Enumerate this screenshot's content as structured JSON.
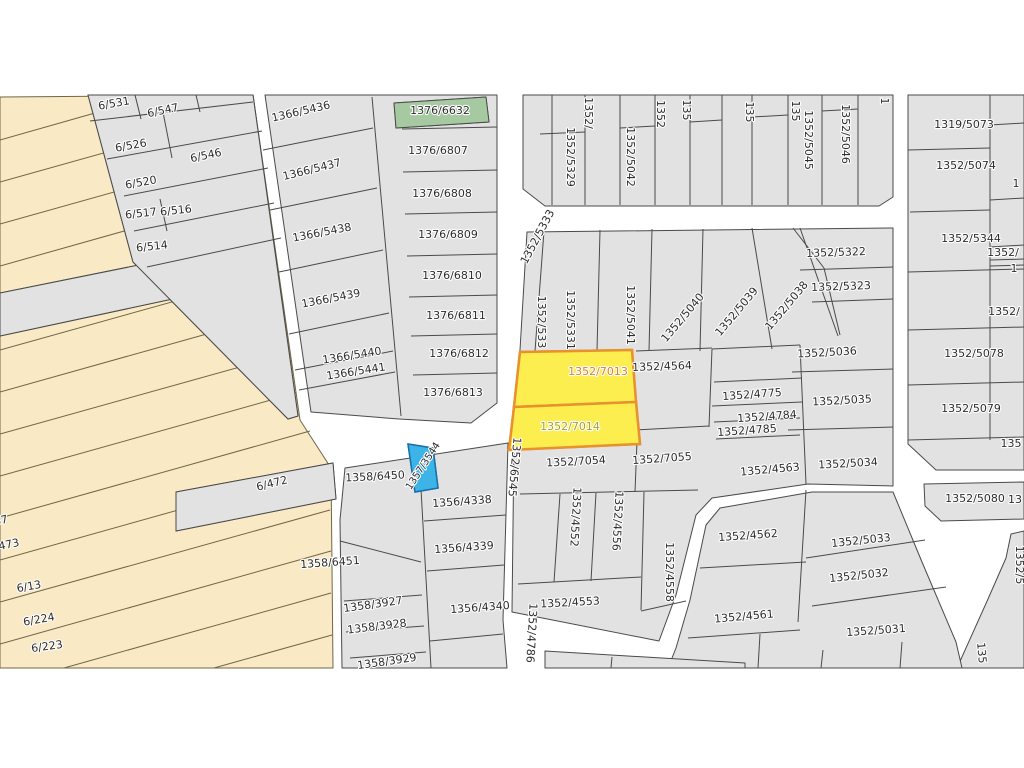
{
  "canvas": {
    "w": 1024,
    "h": 768,
    "bg": "#ffffff",
    "map_top": 93,
    "map_height": 576
  },
  "colors": {
    "parcel": "#e2e2e2",
    "stroke": "#4a4a4a",
    "cream": "#f9e9c4",
    "cream_line": "#6f6747",
    "green": "#a6c9a2",
    "blue": "#3cb4e8",
    "blue_stroke": "#1b6fa8",
    "yellow": "#fbee4e",
    "yellow_stroke": "#e8912d",
    "label": "#2d2d2d",
    "label_7013": "#dd8030",
    "label_7014": "#aea02f",
    "road": "#ffffff"
  },
  "highlighted_parcels": {
    "yellow": [
      "1352/7013",
      "1352/7014"
    ],
    "green": [
      "1376/6632"
    ],
    "blue": [
      "1357/3544"
    ]
  },
  "blocks": [
    {
      "n": "cream-strip-area",
      "f": "cream",
      "s": "cream_line",
      "p": "0,97 253,95 300,420 331,468 333,668 0,668"
    },
    {
      "n": "block-6-5xx-wedge",
      "f": "parcel",
      "p": "88,95 253,95 298,416 288,419 133,262"
    },
    {
      "n": "strip-6-472",
      "f": "parcel",
      "p": "176,492 333,463 336,499 176,531"
    },
    {
      "n": "strip-unlabeled",
      "f": "parcel",
      "p": "0,293 233,246 238,285 0,336"
    },
    {
      "n": "block-1366-1376",
      "f": "parcel",
      "p": "265,95 497,95 497,403 471,423 399,419 311,412"
    },
    {
      "n": "block-top-1352",
      "f": "parcel",
      "p": "523,95 893,95 893,197 879,206 545,206 523,189"
    },
    {
      "n": "block-right-column",
      "f": "parcel",
      "p": "908,95 1024,95 1024,470 936,470 908,444"
    },
    {
      "n": "strip-1352-5080",
      "f": "parcel",
      "p": "924,484 1024,482 1024,519 941,521 925,506"
    },
    {
      "n": "wedge-bottom-right",
      "f": "parcel",
      "p": "1011,534 1024,531 1024,668 957,668 988,599 1006,558"
    },
    {
      "n": "block-middle-1352",
      "f": "parcel",
      "p": "527,232 893,228 893,486 808,484 712,498 696,515 676,595 659,641 512,612 514,440 520,350"
    },
    {
      "n": "block-bottom-right-1352",
      "f": "parcel",
      "p": "812,492 893,492 922,562 956,642 962,668 668,668 676,648 690,600 706,525 720,508"
    },
    {
      "n": "block-1358-1356",
      "f": "parcel",
      "p": "345,468 508,443 503,620 507,668 342,668 340,520"
    },
    {
      "n": "sliver-bottom",
      "f": "parcel",
      "p": "545,651 745,663 745,668 545,668"
    },
    {
      "n": "parcel-1376-6632",
      "f": "green",
      "p": "394,103 486,97 489,122 396,128"
    },
    {
      "n": "parcel-1352-7013",
      "f": "yellow",
      "s": "yellow_stroke",
      "w": 2.5,
      "p": "520,352 632,350 636,402 514,407"
    },
    {
      "n": "parcel-1352-7014",
      "f": "yellow",
      "s": "yellow_stroke",
      "w": 2.5,
      "p": "514,407 636,402 640,444 509,450"
    },
    {
      "n": "parcel-1357-3544",
      "f": "blue",
      "s": "blue_stroke",
      "w": 1.5,
      "p": "408,444 433,448 438,488 415,492"
    }
  ],
  "lines": [
    [
      135,
      95,
      141,
      119
    ],
    [
      90,
      121,
      253,
      102
    ],
    [
      196,
      95,
      200,
      112
    ],
    [
      162,
      107,
      172,
      158
    ],
    [
      107,
      159,
      262,
      131
    ],
    [
      124,
      196,
      268,
      168
    ],
    [
      160,
      199,
      167,
      231
    ],
    [
      134,
      231,
      274,
      203
    ],
    [
      147,
      267,
      281,
      238
    ],
    [
      372,
      97,
      401,
      416
    ],
    [
      263,
      150,
      373,
      128
    ],
    [
      270,
      210,
      377,
      188
    ],
    [
      279,
      272,
      383,
      250
    ],
    [
      289,
      334,
      389,
      313
    ],
    [
      295,
      370,
      393,
      351
    ],
    [
      299,
      390,
      395,
      372
    ],
    [
      402,
      129,
      497,
      127
    ],
    [
      403,
      172,
      497,
      170
    ],
    [
      405,
      214,
      497,
      212
    ],
    [
      407,
      256,
      497,
      254
    ],
    [
      409,
      297,
      497,
      295
    ],
    [
      411,
      336,
      497,
      334
    ],
    [
      413,
      375,
      497,
      373
    ],
    [
      552,
      95,
      552,
      205
    ],
    [
      585,
      95,
      585,
      205
    ],
    [
      620,
      95,
      620,
      205
    ],
    [
      655,
      95,
      655,
      205
    ],
    [
      690,
      95,
      690,
      205
    ],
    [
      722,
      95,
      722,
      205
    ],
    [
      752,
      95,
      752,
      205
    ],
    [
      788,
      95,
      788,
      205
    ],
    [
      822,
      95,
      822,
      205
    ],
    [
      858,
      95,
      858,
      205
    ],
    [
      540,
      134,
      585,
      132
    ],
    [
      620,
      128,
      655,
      126
    ],
    [
      690,
      122,
      722,
      120
    ],
    [
      752,
      117,
      788,
      115
    ],
    [
      822,
      111,
      858,
      109
    ],
    [
      908,
      150,
      990,
      148
    ],
    [
      910,
      212,
      990,
      210
    ],
    [
      908,
      272,
      1024,
      269
    ],
    [
      908,
      330,
      1024,
      327
    ],
    [
      908,
      385,
      1024,
      382
    ],
    [
      908,
      440,
      1024,
      437
    ],
    [
      990,
      95,
      990,
      440
    ],
    [
      990,
      125,
      1024,
      123
    ],
    [
      990,
      200,
      1024,
      198
    ],
    [
      990,
      247,
      1024,
      245
    ],
    [
      990,
      260,
      1024,
      259
    ],
    [
      990,
      266,
      1024,
      265
    ],
    [
      544,
      231,
      535,
      351
    ],
    [
      600,
      230,
      597,
      351
    ],
    [
      652,
      229,
      649,
      351
    ],
    [
      703,
      229,
      700,
      351
    ],
    [
      752,
      228,
      772,
      349
    ],
    [
      800,
      228,
      838,
      336
    ],
    [
      636,
      351,
      712,
      348
    ],
    [
      712,
      349,
      800,
      345
    ],
    [
      712,
      349,
      709,
      427
    ],
    [
      634,
      430,
      709,
      426
    ],
    [
      714,
      382,
      802,
      378
    ],
    [
      712,
      406,
      802,
      402
    ],
    [
      714,
      422,
      800,
      418
    ],
    [
      716,
      439,
      800,
      435
    ],
    [
      800,
      345,
      806,
      484
    ],
    [
      793,
      228,
      824,
      268
    ],
    [
      800,
      270,
      893,
      267
    ],
    [
      812,
      302,
      893,
      299
    ],
    [
      824,
      268,
      840,
      335
    ],
    [
      792,
      372,
      893,
      369
    ],
    [
      788,
      430,
      893,
      427
    ],
    [
      637,
      441,
      635,
      492
    ],
    [
      520,
      494,
      698,
      490
    ],
    [
      560,
      494,
      554,
      582
    ],
    [
      596,
      493,
      591,
      581
    ],
    [
      644,
      492,
      641,
      610
    ],
    [
      518,
      584,
      641,
      577
    ],
    [
      641,
      611,
      686,
      601
    ],
    [
      806,
      490,
      798,
      622
    ],
    [
      700,
      568,
      806,
      562
    ],
    [
      688,
      638,
      800,
      630
    ],
    [
      806,
      558,
      925,
      540
    ],
    [
      812,
      606,
      946,
      587
    ],
    [
      760,
      634,
      758,
      668
    ],
    [
      823,
      650,
      821,
      668
    ],
    [
      902,
      642,
      900,
      668
    ],
    [
      421,
      489,
      431,
      668
    ],
    [
      424,
      521,
      506,
      515
    ],
    [
      427,
      571,
      504,
      565
    ],
    [
      430,
      641,
      503,
      634
    ],
    [
      340,
      541,
      421,
      562
    ],
    [
      344,
      601,
      422,
      595
    ],
    [
      346,
      632,
      424,
      626
    ],
    [
      350,
      658,
      426,
      652
    ],
    [
      612,
      657,
      611,
      668
    ]
  ],
  "cream_lines": [
    [
      0,
      140,
      95,
      113
    ],
    [
      0,
      182,
      150,
      140
    ],
    [
      0,
      224,
      200,
      168
    ],
    [
      0,
      266,
      245,
      197
    ],
    [
      0,
      308,
      255,
      237
    ],
    [
      0,
      350,
      279,
      272
    ],
    [
      0,
      392,
      285,
      312
    ],
    [
      0,
      434,
      290,
      353
    ],
    [
      0,
      476,
      296,
      393
    ],
    [
      0,
      518,
      310,
      431
    ],
    [
      0,
      560,
      328,
      468
    ],
    [
      0,
      602,
      330,
      510
    ],
    [
      0,
      644,
      331,
      551
    ],
    [
      64,
      668,
      331,
      593
    ],
    [
      214,
      668,
      332,
      635
    ]
  ],
  "labels": [
    {
      "t": "6/531",
      "x": 114,
      "y": 104,
      "r": -10
    },
    {
      "t": "6/547",
      "x": 163,
      "y": 111,
      "r": -12
    },
    {
      "t": "6/526",
      "x": 131,
      "y": 146,
      "r": -10
    },
    {
      "t": "6/546",
      "x": 206,
      "y": 156,
      "r": -12
    },
    {
      "t": "6/520",
      "x": 141,
      "y": 183,
      "r": -10
    },
    {
      "t": "6/517",
      "x": 141,
      "y": 214,
      "r": -6
    },
    {
      "t": "6/516",
      "x": 176,
      "y": 211,
      "r": -6
    },
    {
      "t": "6/514",
      "x": 152,
      "y": 247,
      "r": -6
    },
    {
      "t": "6/472",
      "x": 272,
      "y": 484,
      "r": -14
    },
    {
      "t": "87",
      "x": 1,
      "y": 521,
      "r": -12
    },
    {
      "t": "473",
      "x": 9,
      "y": 545,
      "r": -12
    },
    {
      "t": "6/13",
      "x": 29,
      "y": 587,
      "r": -10
    },
    {
      "t": "6/224",
      "x": 39,
      "y": 620,
      "r": -10
    },
    {
      "t": "6/223",
      "x": 47,
      "y": 647,
      "r": -8
    },
    {
      "t": "1366/5436",
      "x": 301,
      "y": 112,
      "r": -13
    },
    {
      "t": "1366/5437",
      "x": 312,
      "y": 170,
      "r": -14
    },
    {
      "t": "1366/5438",
      "x": 322,
      "y": 233,
      "r": -11
    },
    {
      "t": "1366/5439",
      "x": 331,
      "y": 299,
      "r": -11
    },
    {
      "t": "1366/5440",
      "x": 352,
      "y": 356,
      "r": -9
    },
    {
      "t": "1366/5441",
      "x": 356,
      "y": 372,
      "r": -9
    },
    {
      "t": "1376/6632",
      "x": 440,
      "y": 111
    },
    {
      "t": "1376/6807",
      "x": 438,
      "y": 151
    },
    {
      "t": "1376/6808",
      "x": 442,
      "y": 194
    },
    {
      "t": "1376/6809",
      "x": 448,
      "y": 235
    },
    {
      "t": "1376/6810",
      "x": 452,
      "y": 276
    },
    {
      "t": "1376/6811",
      "x": 456,
      "y": 316
    },
    {
      "t": "1376/6812",
      "x": 459,
      "y": 354
    },
    {
      "t": "1376/6813",
      "x": 453,
      "y": 393
    },
    {
      "t": "1352/5329",
      "x": 570,
      "y": 157,
      "r": 90
    },
    {
      "t": "1352/",
      "x": 588,
      "y": 113,
      "r": 90
    },
    {
      "t": "1352/5042",
      "x": 630,
      "y": 157,
      "r": 90
    },
    {
      "t": "1352",
      "x": 660,
      "y": 114,
      "r": 90
    },
    {
      "t": "135",
      "x": 686,
      "y": 110,
      "r": 90
    },
    {
      "t": "135",
      "x": 749,
      "y": 112,
      "r": 90
    },
    {
      "t": "135",
      "x": 795,
      "y": 111,
      "r": 90
    },
    {
      "t": "1352/5045",
      "x": 808,
      "y": 140,
      "r": 90
    },
    {
      "t": "1352/5046",
      "x": 845,
      "y": 134,
      "r": 90
    },
    {
      "t": "1",
      "x": 884,
      "y": 101,
      "r": 90
    },
    {
      "t": "1319/5073",
      "x": 964,
      "y": 125
    },
    {
      "t": "1352/5074",
      "x": 966,
      "y": 166
    },
    {
      "t": "1",
      "x": 1016,
      "y": 184
    },
    {
      "t": "1352/5344",
      "x": 971,
      "y": 239
    },
    {
      "t": "1352/",
      "x": 1003,
      "y": 253
    },
    {
      "t": "1",
      "x": 1014,
      "y": 269
    },
    {
      "t": "1352/",
      "x": 1004,
      "y": 312
    },
    {
      "t": "1352/5078",
      "x": 974,
      "y": 354
    },
    {
      "t": "1352/5079",
      "x": 971,
      "y": 409
    },
    {
      "t": "135",
      "x": 1011,
      "y": 444
    },
    {
      "t": "1352/5080",
      "x": 975,
      "y": 499
    },
    {
      "t": "13",
      "x": 1015,
      "y": 500
    },
    {
      "t": "1352/5333",
      "x": 538,
      "y": 237,
      "r": -62
    },
    {
      "t": "1352/533",
      "x": 541,
      "y": 322,
      "r": 90
    },
    {
      "t": "1352/5331",
      "x": 570,
      "y": 320,
      "r": 90
    },
    {
      "t": "1352/5041",
      "x": 630,
      "y": 315,
      "r": 90
    },
    {
      "t": "1352/5040",
      "x": 683,
      "y": 318,
      "r": -50
    },
    {
      "t": "1352/5039",
      "x": 737,
      "y": 312,
      "r": -50
    },
    {
      "t": "1352/5038",
      "x": 787,
      "y": 306,
      "r": -50
    },
    {
      "t": "1352/5322",
      "x": 836,
      "y": 253,
      "r": -2
    },
    {
      "t": "1352/5323",
      "x": 841,
      "y": 287,
      "r": -2
    },
    {
      "t": "1352/5036",
      "x": 827,
      "y": 353,
      "r": -3
    },
    {
      "t": "1352/5035",
      "x": 842,
      "y": 401,
      "r": -3
    },
    {
      "t": "1352/5034",
      "x": 848,
      "y": 464,
      "r": -3
    },
    {
      "t": "1352/4564",
      "x": 662,
      "y": 367,
      "r": -2
    },
    {
      "t": "1352/4775",
      "x": 752,
      "y": 395,
      "r": -4
    },
    {
      "t": "1352/4784",
      "x": 767,
      "y": 417,
      "r": -4
    },
    {
      "t": "1352/4785",
      "x": 747,
      "y": 431,
      "r": -4
    },
    {
      "t": "1352/4563",
      "x": 770,
      "y": 470,
      "r": -5
    },
    {
      "t": "1352/7013",
      "x": 598,
      "y": 372,
      "c": "label_7013"
    },
    {
      "t": "1352/7014",
      "x": 570,
      "y": 427,
      "c": "label_7014"
    },
    {
      "t": "1352/7054",
      "x": 576,
      "y": 462,
      "r": -3
    },
    {
      "t": "1352/7055",
      "x": 662,
      "y": 459,
      "r": -4
    },
    {
      "t": "1352/4552",
      "x": 575,
      "y": 517,
      "r": 93
    },
    {
      "t": "1352/4556",
      "x": 617,
      "y": 521,
      "r": 93
    },
    {
      "t": "1352/4558",
      "x": 669,
      "y": 572,
      "r": 90
    },
    {
      "t": "1352/4553",
      "x": 570,
      "y": 603,
      "r": -3
    },
    {
      "t": "1352/6545",
      "x": 514,
      "y": 467,
      "r": 95
    },
    {
      "t": "1352/4786",
      "x": 531,
      "y": 633,
      "r": 93
    },
    {
      "t": "1357/3544",
      "x": 423,
      "y": 466,
      "r": -57,
      "s": 10
    },
    {
      "t": "1358/6450",
      "x": 375,
      "y": 477,
      "r": -3
    },
    {
      "t": "1358/6451",
      "x": 330,
      "y": 563,
      "r": -4
    },
    {
      "t": "1356/4338",
      "x": 462,
      "y": 502,
      "r": -4
    },
    {
      "t": "1356/4339",
      "x": 464,
      "y": 548,
      "r": -4
    },
    {
      "t": "1356/4340",
      "x": 480,
      "y": 608,
      "r": -4
    },
    {
      "t": "1358/3927",
      "x": 373,
      "y": 605,
      "r": -8
    },
    {
      "t": "1358/3928",
      "x": 377,
      "y": 627,
      "r": -7
    },
    {
      "t": "1358/3929",
      "x": 387,
      "y": 662,
      "r": -8
    },
    {
      "t": "1352/4562",
      "x": 748,
      "y": 536,
      "r": -4
    },
    {
      "t": "1352/4561",
      "x": 744,
      "y": 617,
      "r": -5
    },
    {
      "t": "1352/5033",
      "x": 861,
      "y": 541,
      "r": -6
    },
    {
      "t": "1352/5032",
      "x": 859,
      "y": 576,
      "r": -6
    },
    {
      "t": "1352/5031",
      "x": 876,
      "y": 631,
      "r": -4
    },
    {
      "t": "1352/5",
      "x": 1019,
      "y": 565,
      "r": 90
    },
    {
      "t": "135",
      "x": 981,
      "y": 653,
      "r": 85
    }
  ]
}
